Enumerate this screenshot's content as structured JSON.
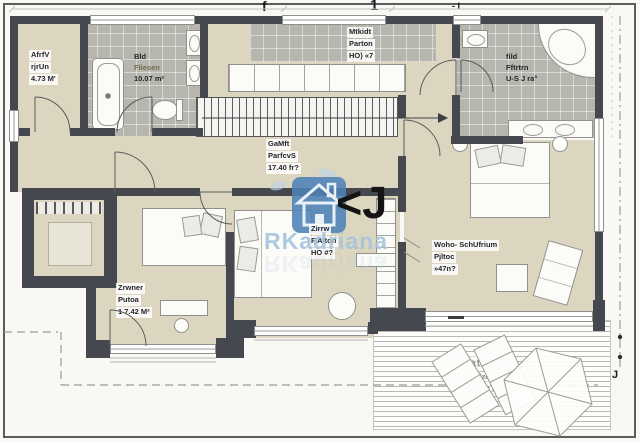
{
  "plan": {
    "watermark": {
      "brand": "RKadriana",
      "glyph": "<J",
      "house_icon": "house-logo"
    },
    "markers": {
      "top_left": "f",
      "top_center": "1",
      "top_right": "- I",
      "right_bottom": "J"
    },
    "rooms": {
      "utility": {
        "l1": "AfrfV",
        "l2": "rjrUn",
        "l3": "4.73 M'"
      },
      "bath": {
        "l1": "Bld",
        "l2": "Fliesen",
        "l3": "10.07 m²"
      },
      "kitchen": {
        "l1": "Mtkidt",
        "l2": "Parton",
        "l3": "HO) «7"
      },
      "bath2": {
        "l1": "fild",
        "l2": "Fftrtrn",
        "l3": "U-S J ra°"
      },
      "hall": {
        "l1": "GaMft",
        "l2": "ParfcvS",
        "l3": "17.40 fr?"
      },
      "living": {
        "l1": "Woho- SchUfrium",
        "l2": "Pjltoc",
        "l3": "»47n?"
      },
      "bedroom1": {
        "l1": "Zirrw",
        "l2": "P.Alton",
        "l3": "HO #?"
      },
      "bedroom2": {
        "l1": "Zrwner",
        "l2": "Putoa",
        "l3": "1 7.42 M²"
      },
      "terrace": {
        "l1": "Tatasse",
        "l2": "Holzdeke",
        "l3": "17.63 m²"
      }
    },
    "colors": {
      "wall": "#45494f",
      "floor": "#dcd6c1",
      "tile": "#b7b6ae",
      "watermark_blue": "#4d82b6",
      "watermark_text": "#a6c4dd"
    }
  }
}
